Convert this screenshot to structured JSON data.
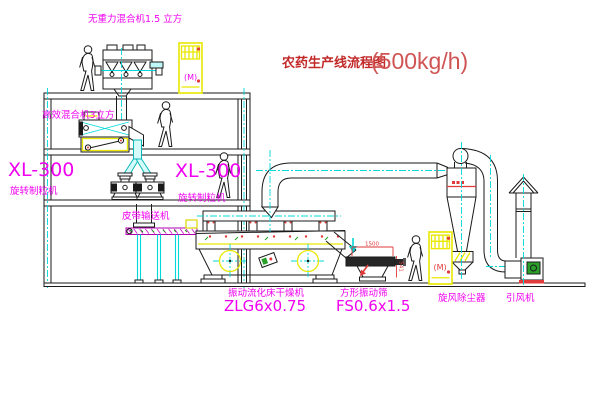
{
  "title": {
    "text": "农药生产线流程图",
    "capacity": "(500kg/h)"
  },
  "labels": {
    "top_mixer": "无重力混合机1.5 立方",
    "mixer2": "高效混合机3立方",
    "granulator_left_model": "XL-300",
    "granulator_left_name": "旋转制粒机",
    "granulator_right_model": "XL-300",
    "granulator_right_name": "旋转制粒机",
    "belt_conveyor": "皮带输送机",
    "dryer_name": "振动流化床干燥机",
    "dryer_model": "ZLG6x0.75",
    "screen_name": "方形振动筛",
    "screen_model": "FS0.6x1.5",
    "cyclone": "旋风除尘器",
    "fan": "引风机"
  },
  "dims": {
    "screen_width": "1500",
    "screen_height": "541"
  },
  "cabinets": {
    "symbol": "(M)"
  },
  "colors": {
    "label_magenta": "#f000f0",
    "title_red": "#c22a2a",
    "line_cyan": "#00d9d9",
    "accent_yellow": "#e8e800",
    "motor_green": "#2aa02a"
  }
}
